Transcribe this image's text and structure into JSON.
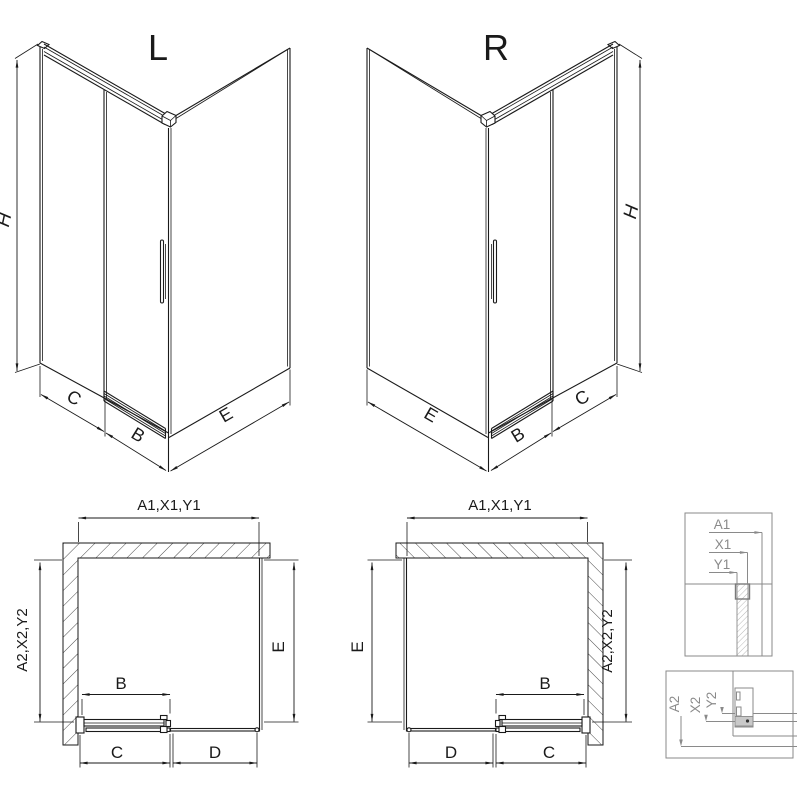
{
  "colors": {
    "line": "#1a1a1a",
    "detail_gray": "#8a8a8a",
    "background": "#ffffff"
  },
  "iso_left": {
    "title": "L",
    "dim_height": "H",
    "dim_c": "C",
    "dim_b": "B",
    "dim_e": "E"
  },
  "iso_right": {
    "title": "R",
    "dim_height": "H",
    "dim_e": "E",
    "dim_b": "B",
    "dim_c": "C"
  },
  "plan_left": {
    "dim_top": "A1,X1,Y1",
    "dim_left": "A2,X2,Y2",
    "dim_right": "E",
    "dim_b": "B",
    "dim_c": "C",
    "dim_d": "D"
  },
  "plan_right": {
    "dim_top": "A1,X1,Y1",
    "dim_left": "E",
    "dim_right": "A2,X2,Y2",
    "dim_b": "B",
    "dim_d": "D",
    "dim_c": "C"
  },
  "detail_top": {
    "label_a1": "A1",
    "label_x1": "X1",
    "label_y1": "Y1"
  },
  "detail_bottom": {
    "label_a2": "A2",
    "label_x2": "X2",
    "label_y2": "Y2"
  }
}
